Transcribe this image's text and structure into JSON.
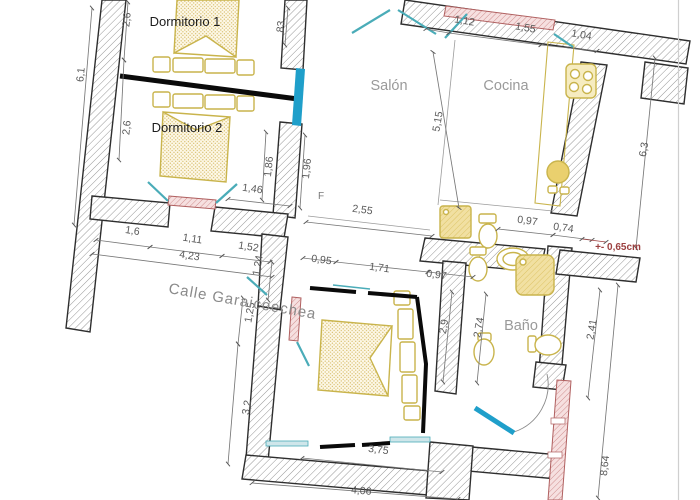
{
  "drawing_title": "apartment-floor-plan",
  "street_label": {
    "value": "Calle Garaicoechea",
    "x": 168,
    "y": 293,
    "rot": 10
  },
  "rooms": [
    {
      "id": "dormitorio-1",
      "label": "Dormitorio 1",
      "x": 185,
      "y": 26,
      "dark": true
    },
    {
      "id": "dormitorio-2",
      "label": "Dormitorio 2",
      "x": 187,
      "y": 132,
      "dark": true
    },
    {
      "id": "salon",
      "label": "Salón",
      "x": 389,
      "y": 90,
      "dark": false
    },
    {
      "id": "cocina",
      "label": "Cocina",
      "x": 506,
      "y": 90,
      "dark": false
    },
    {
      "id": "bano",
      "label": "Baño",
      "x": 521,
      "y": 330,
      "dark": false
    }
  ],
  "dimension_labels": [
    {
      "value": "2,6",
      "x": 130,
      "y": 20,
      "rot": -84
    },
    {
      "value": "6,1",
      "x": 84,
      "y": 75,
      "rot": -84
    },
    {
      "value": "2,6",
      "x": 130,
      "y": 128,
      "rot": -84
    },
    {
      "value": "83",
      "x": 284,
      "y": 27,
      "rot": -84
    },
    {
      "value": "1,12",
      "x": 464,
      "y": 24,
      "rot": 10
    },
    {
      "value": "1,55",
      "x": 525,
      "y": 31,
      "rot": 10
    },
    {
      "value": "1,04",
      "x": 581,
      "y": 38,
      "rot": 10
    },
    {
      "value": "5,15",
      "x": 441,
      "y": 122,
      "rot": -80
    },
    {
      "value": "6,3",
      "x": 647,
      "y": 150,
      "rot": -80
    },
    {
      "value": "1,86",
      "x": 272,
      "y": 167,
      "rot": -84
    },
    {
      "value": "1,96",
      "x": 310,
      "y": 169,
      "rot": -84
    },
    {
      "value": "1,46",
      "x": 252,
      "y": 192,
      "rot": 8
    },
    {
      "value": "2,55",
      "x": 362,
      "y": 213,
      "rot": 8
    },
    {
      "value": "0,95",
      "x": 321,
      "y": 263,
      "rot": 8
    },
    {
      "value": "1,71",
      "x": 379,
      "y": 271,
      "rot": 8
    },
    {
      "value": "0,97",
      "x": 436,
      "y": 278,
      "rot": 8
    },
    {
      "value": "0,97",
      "x": 527,
      "y": 224,
      "rot": 8
    },
    {
      "value": "0,74",
      "x": 563,
      "y": 231,
      "rot": 8
    },
    {
      "value": "1,6",
      "x": 132,
      "y": 234,
      "rot": 9
    },
    {
      "value": "1,11",
      "x": 192,
      "y": 242,
      "rot": 9
    },
    {
      "value": "1,52",
      "x": 248,
      "y": 250,
      "rot": 9
    },
    {
      "value": "4,23",
      "x": 189,
      "y": 259,
      "rot": 9
    },
    {
      "value": "1,24",
      "x": 261,
      "y": 266,
      "rot": -80
    },
    {
      "value": "1,25",
      "x": 253,
      "y": 313,
      "rot": -80
    },
    {
      "value": "3,2",
      "x": 250,
      "y": 408,
      "rot": -80
    },
    {
      "value": "2,9",
      "x": 447,
      "y": 327,
      "rot": -80
    },
    {
      "value": "2,74",
      "x": 482,
      "y": 328,
      "rot": -80
    },
    {
      "value": "2,41",
      "x": 595,
      "y": 330,
      "rot": -80
    },
    {
      "value": "8,64",
      "x": 608,
      "y": 466,
      "rot": -84
    },
    {
      "value": "3,75",
      "x": 378,
      "y": 453,
      "rot": 7
    },
    {
      "value": "4,06",
      "x": 361,
      "y": 494,
      "rot": 5
    }
  ],
  "annotations": [
    {
      "value": "+- 0,65cm",
      "x": 618,
      "y": 250,
      "rot": 0,
      "style": "note-red"
    },
    {
      "value": "F",
      "x": 321,
      "y": 199,
      "rot": 0,
      "style": "note-gray"
    }
  ],
  "fixtures": [
    "double-bed-dormitorio-1",
    "double-bed-dormitorio-2",
    "double-bed-bottom-bedroom",
    "stove",
    "kitchen-counter",
    "kitchen-sink",
    "washing-machine",
    "toilet-laundry",
    "hand-sink",
    "toilet-bath",
    "shower",
    "bidet",
    "toilet-bath-2",
    "entry-door"
  ],
  "colors": {
    "wall_outline": "#2e2e2e",
    "wall_hatch": "#8a8a8a",
    "fixture": "#c9b44c",
    "window_pink": "#c97f7f",
    "door_teal": "#4aacb8",
    "new_wall_cyan": "#1f9fca",
    "partition_black": "#0a0a0a",
    "dim_text": "#5a5a5a",
    "room_text": "#9a9a9a",
    "red_note": "#9c4040"
  }
}
